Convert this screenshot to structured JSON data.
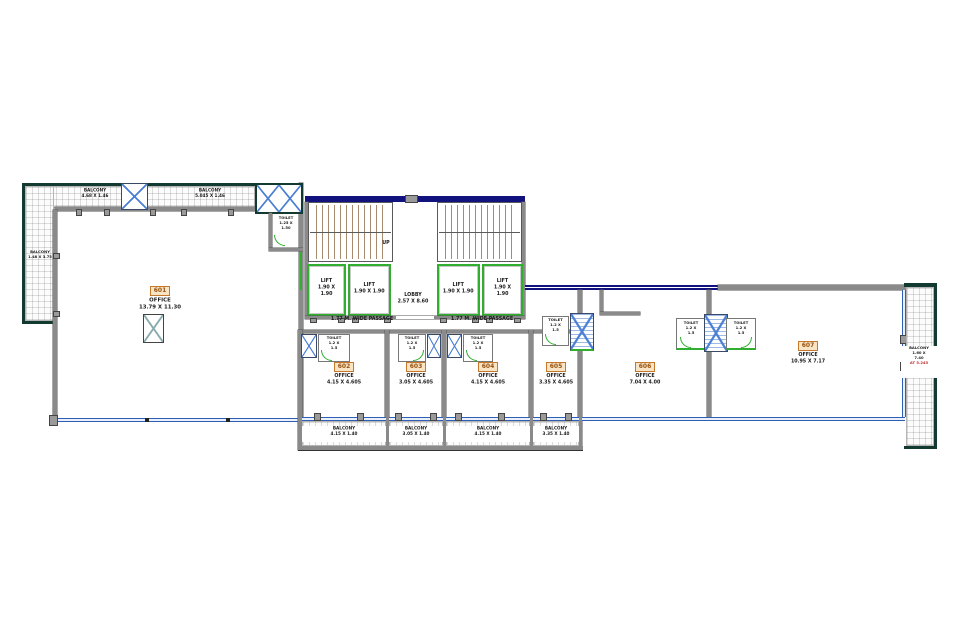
{
  "drawing_title": "floor-plan",
  "colors": {
    "outer_wall": "#123a31",
    "inner_wall": "#8a8a8a",
    "stair_band": "#12127e",
    "window_line": "#2f5fb3",
    "lift_green": "#2fae2f",
    "duct_blue": "#4a7fd4",
    "badge_border": "#c5782a",
    "badge_bg": "#f9e4c6",
    "badge_text": "#96520f",
    "stair_tread": "#a68a6e",
    "note_red": "#c03030"
  },
  "left_block": {
    "balcony_top_left": {
      "label": "BALCONY",
      "dims": "4.68 X 1.46"
    },
    "balcony_top_right": {
      "label": "BALCONY",
      "dims": "5.045 X 1.46"
    },
    "balcony_left": {
      "label": "BALCONY",
      "dims": "1.48 X 3.75"
    },
    "toilet": {
      "label": "TOILET",
      "dims": "1.25 X 1.50"
    },
    "office": {
      "number": "601",
      "label": "OFFICE",
      "dims": "13.79 X 11.30"
    }
  },
  "core": {
    "up": "UP",
    "lobby": {
      "label": "LOBBY",
      "dims": "2.57 X 8.60"
    },
    "lifts": [
      {
        "label": "LIFT",
        "dims": "1.90 X 1.90"
      },
      {
        "label": "LIFT",
        "dims": "1.90 X 1.90"
      },
      {
        "label": "LIFT",
        "dims": "1.90 X 1.90"
      },
      {
        "label": "LIFT",
        "dims": "1.90 X 1.90"
      }
    ],
    "passage_left": "1.77 M. WIDE PASSAGE",
    "passage_right": "1.77 M. WIDE PASSAGE"
  },
  "offices": [
    {
      "number": "602",
      "label": "OFFICE",
      "dims": "4.15 X 4.605"
    },
    {
      "number": "603",
      "label": "OFFICE",
      "dims": "3.05 X 4.605"
    },
    {
      "number": "604",
      "label": "OFFICE",
      "dims": "4.15 X 4.605"
    },
    {
      "number": "605",
      "label": "OFFICE",
      "dims": "3.35 X 4.605"
    },
    {
      "number": "606",
      "label": "OFFICE",
      "dims": "7.04 X 4.00"
    },
    {
      "number": "607",
      "label": "OFFICE",
      "dims": "10.95 X 7.17"
    }
  ],
  "small_toilet": {
    "label": "TOILET",
    "dims": "1.2 X 1.5"
  },
  "balconies_bottom": [
    {
      "label": "BALCONY",
      "dims": "4.15 X 1.40"
    },
    {
      "label": "BALCONY",
      "dims": "3.05 X 1.40"
    },
    {
      "label": "BALCONY",
      "dims": "4.15 X 1.40"
    },
    {
      "label": "BALCONY",
      "dims": "3.35 X 1.40"
    }
  ],
  "balcony_right": {
    "label": "BALCONY",
    "dims": "1.60 X 7.40",
    "note": "AT 5.245"
  }
}
